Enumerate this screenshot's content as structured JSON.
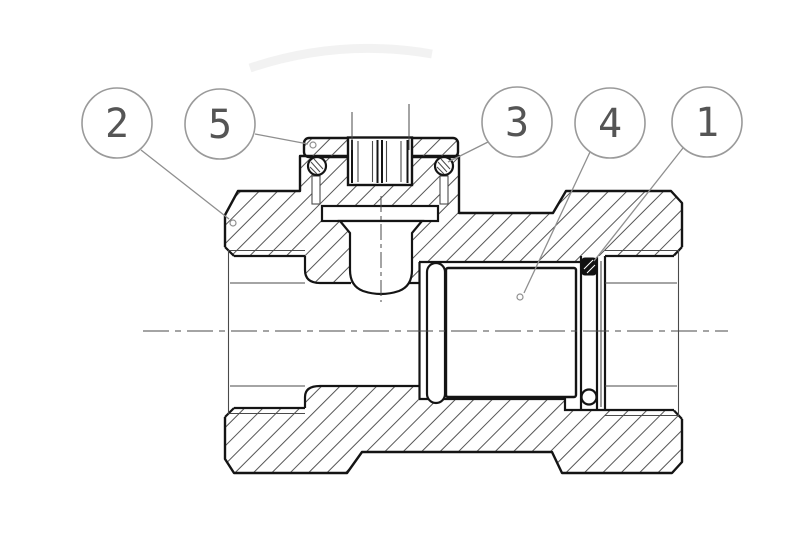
{
  "drawing": {
    "type": "technical-section-drawing",
    "canvas": {
      "width": 800,
      "height": 545
    },
    "colors": {
      "background": "#ffffff",
      "outline": "#141414",
      "thin_line": "#4a4a4a",
      "hatch": "#555555",
      "leader": "#8f8f8f",
      "balloon_stroke": "#9a9a9a",
      "balloon_text": "#555555",
      "seal_fill": "#111111"
    },
    "balloon_radius": 35,
    "callouts": [
      {
        "label": "2",
        "cx": 117,
        "cy": 123,
        "leader": {
          "x1": 141,
          "y1": 150,
          "x2": 229,
          "y2": 219
        },
        "dot": {
          "x": 233,
          "y": 223
        }
      },
      {
        "label": "5",
        "cx": 220,
        "cy": 124,
        "leader": {
          "x1": 255,
          "y1": 134,
          "x2": 308,
          "y2": 144
        },
        "dot": {
          "x": 313,
          "y": 145
        }
      },
      {
        "label": "3",
        "cx": 517,
        "cy": 122,
        "leader": {
          "x1": 488,
          "y1": 142,
          "x2": 448,
          "y2": 162
        },
        "dot": null
      },
      {
        "label": "4",
        "cx": 610,
        "cy": 123,
        "leader": {
          "x1": 590,
          "y1": 152,
          "x2": 524,
          "y2": 293
        },
        "dot": {
          "x": 520,
          "y": 297
        }
      },
      {
        "label": "1",
        "cx": 707,
        "cy": 122,
        "leader": {
          "x1": 683,
          "y1": 148,
          "x2": 594,
          "y2": 261
        },
        "dot": null
      }
    ]
  }
}
